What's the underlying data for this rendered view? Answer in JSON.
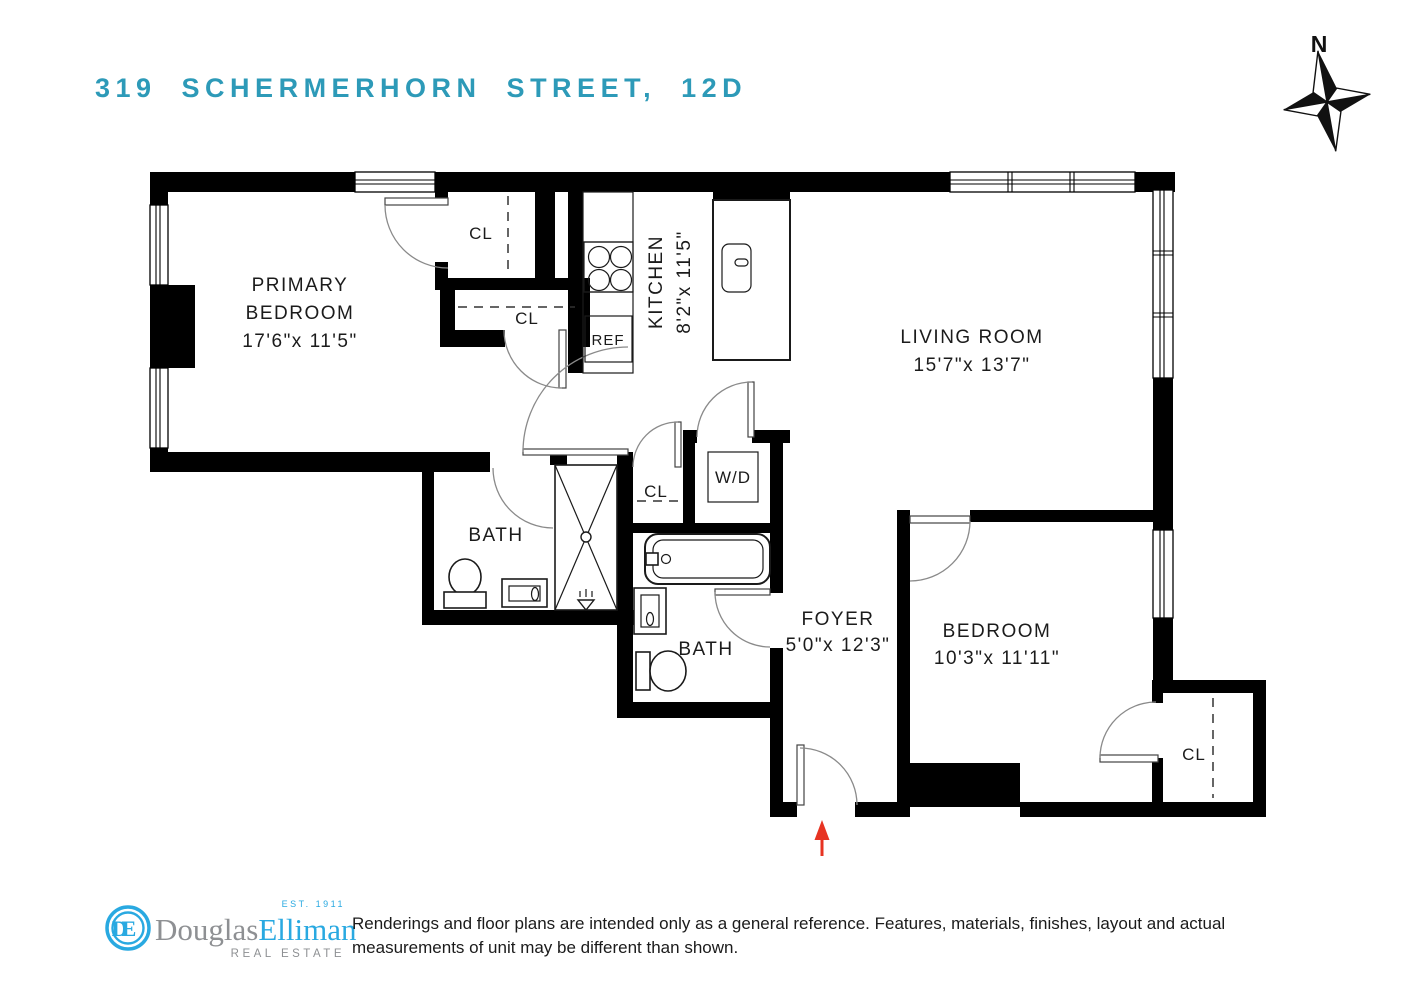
{
  "title": "319  SCHERMERHORN  STREET,  12D",
  "compass": {
    "north_label": "N"
  },
  "rooms": {
    "primary_bedroom": {
      "line1": "PRIMARY",
      "line2": "BEDROOM",
      "dims": "17'6\"x 11'5\""
    },
    "kitchen": {
      "name": "KITCHEN",
      "dims": "8'2\"x 11'5\""
    },
    "living_room": {
      "name": "LIVING ROOM",
      "dims": "15'7\"x 13'7\""
    },
    "primary_bath": {
      "name": "BATH"
    },
    "second_bath": {
      "name": "BATH"
    },
    "foyer": {
      "name": "FOYER",
      "dims": "5'0\"x 12'3\""
    },
    "bedroom": {
      "name": "BEDROOM",
      "dims": "10'3\"x 11'11\""
    }
  },
  "labels": {
    "closet": "CL",
    "washer_dryer": "W/D",
    "refrigerator": "REF"
  },
  "footer": {
    "brand_monogram_d": "D",
    "brand_monogram_e": "E",
    "brand_first": "Douglas",
    "brand_second": "Elliman",
    "established": "EST. 1911",
    "division": "REAL ESTATE",
    "disclaimer_line1": "Renderings and floor plans are intended only as a general reference. Features, materials, finishes, layout and actual",
    "disclaimer_line2": "measurements of unit may be different than shown."
  },
  "colors": {
    "title_teal": "#2d9ab8",
    "logo_cyan": "#29a9e1",
    "logo_gray": "#8e9093",
    "entry_arrow_red": "#e73322",
    "wall_black": "#000000",
    "label_dark": "#1b1b1b"
  }
}
